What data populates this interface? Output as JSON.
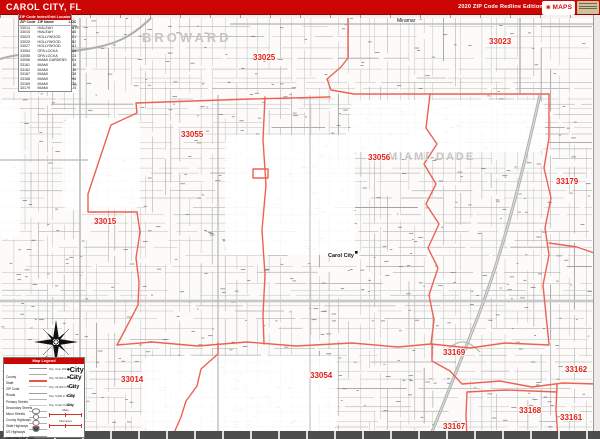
{
  "header": {
    "title": "CAROL CITY, FL",
    "edition": "2020 ZIP Code Redline Edition",
    "logo_maps": "MAPS",
    "accent_color": "#cb0604"
  },
  "zip_index": {
    "title": "ZIP Code Index/Grid Locator",
    "columns": [
      "ZIP Code",
      "ZIP Name",
      "LOC"
    ],
    "rows": [
      {
        "zip": "33014",
        "name": "HIALEAH",
        "loc": "B7"
      },
      {
        "zip": "33015",
        "name": "HIALEAH",
        "loc": "A6"
      },
      {
        "zip": "33023",
        "name": "HOLLYWOOD",
        "loc": "D1"
      },
      {
        "zip": "33025",
        "name": "HOLLYWOOD",
        "loc": "B2"
      },
      {
        "zip": "33027",
        "name": "HOLLYWOOD",
        "loc": "A1"
      },
      {
        "zip": "33054",
        "name": "OPA LOCKA",
        "loc": "D8"
      },
      {
        "zip": "33055",
        "name": "OPA LOCKA",
        "loc": "C4"
      },
      {
        "zip": "33056",
        "name": "MIAMI GARDENS",
        "loc": "E4"
      },
      {
        "zip": "33161",
        "name": "MIAMI",
        "loc": "J8"
      },
      {
        "zip": "33162",
        "name": "MIAMI",
        "loc": "J6"
      },
      {
        "zip": "33167",
        "name": "MIAMI",
        "loc": "G8"
      },
      {
        "zip": "33168",
        "name": "MIAMI",
        "loc": "H8"
      },
      {
        "zip": "33169",
        "name": "MIAMI",
        "loc": "G6"
      },
      {
        "zip": "33179",
        "name": "MIAMI",
        "loc": "J4"
      }
    ]
  },
  "map": {
    "county_labels": [
      {
        "text": "BROWARD",
        "x": 142,
        "y": 42,
        "size": 13,
        "ls": 3
      },
      {
        "text": "MIAMI-DADE",
        "x": 388,
        "y": 160,
        "size": 11,
        "ls": 2
      }
    ],
    "city_labels": [
      {
        "text": "Miramar",
        "x": 397,
        "y": 22,
        "size": 5,
        "bold": false,
        "marker": false
      },
      {
        "text": "Carol City",
        "x": 328,
        "y": 257,
        "size": 5.5,
        "bold": true,
        "marker": true,
        "mx": 355,
        "my": 251
      }
    ],
    "zip_labels": [
      {
        "text": "33055",
        "x": 181,
        "y": 137
      },
      {
        "text": "33025",
        "x": 253,
        "y": 60
      },
      {
        "text": "33023",
        "x": 489,
        "y": 44
      },
      {
        "text": "33056",
        "x": 368,
        "y": 160
      },
      {
        "text": "33179",
        "x": 556,
        "y": 184
      },
      {
        "text": "33015",
        "x": 94,
        "y": 224
      },
      {
        "text": "33014",
        "x": 121,
        "y": 382
      },
      {
        "text": "33054",
        "x": 310,
        "y": 378
      },
      {
        "text": "33169",
        "x": 443,
        "y": 355
      },
      {
        "text": "33162",
        "x": 565,
        "y": 372
      },
      {
        "text": "33168",
        "x": 519,
        "y": 413
      },
      {
        "text": "33161",
        "x": 560,
        "y": 420
      },
      {
        "text": "33167",
        "x": 443,
        "y": 429
      }
    ],
    "boundary_color": "#ed6154",
    "zip_label_color": "#e02019",
    "boundaries": [
      "M348,14 L348,58 L341,67 L327,79 L331,90 L354,94 L549,94",
      "M136,103 L250,99 L330,97",
      "M136,103 L137,113 L111,125 L88,194 L88,212 L137,212",
      "M137,212 L140,232 L136,258 L139,282 L138,305 L126,328 L117,345",
      "M117,345 L152,342 L198,346 L247,342 L296,346 L352,343 L398,347 L431,344",
      "M431,344 L470,348 L505,343 L549,345",
      "M265,97 L263,140 L266,185 L262,230 L265,275 L263,315 L264,344",
      "M430,94 L426,128 L437,144 L424,164 L436,184 L426,204 L439,224 L428,248 L438,268 L429,295 L434,320 L431,344",
      "M549,94 L549,138 L544,168 L551,198 L545,228 L549,255 L543,285 L546,315 L549,344",
      "M549,243 L577,247 L597,254",
      "M432,344 L432,361 L450,371 L462,384 L500,381 L532,387 L563,383 L597,384",
      "M597,330 L597,384",
      "M467,392 L466,415 L467,439",
      "M467,392 L505,390 L532,391 L557,392",
      "M557,385 L556,410 L558,439",
      "M218,343 L218,354 L201,369 L197,386 L186,401 L181,417 L174,433",
      "M253,169 L268,169 L268,178 L253,178 Z"
    ]
  },
  "legend": {
    "title": "Map Legend",
    "line_items": [
      "County",
      "State",
      "ZIP Code",
      "Roads",
      "Primary Streets",
      "Secondary Streets",
      "Minor Streets",
      "County Highways",
      "State Highways",
      "US Highways",
      "Interstate Highways",
      "Toll Roads"
    ],
    "city_items": [
      {
        "label": "Pop. Over 250,000",
        "sample": "City"
      },
      {
        "label": "Pop. 50,000 to 250,000",
        "sample": "City"
      },
      {
        "label": "Pop. 25,000 to 50,000",
        "sample": "City"
      },
      {
        "label": "Pop. 5,000 to 25,000",
        "sample": "City"
      },
      {
        "label": "Pop. Under 5,000",
        "sample": "City"
      }
    ],
    "scales": [
      {
        "label": "Miles"
      },
      {
        "label": "Kilometers"
      }
    ]
  }
}
